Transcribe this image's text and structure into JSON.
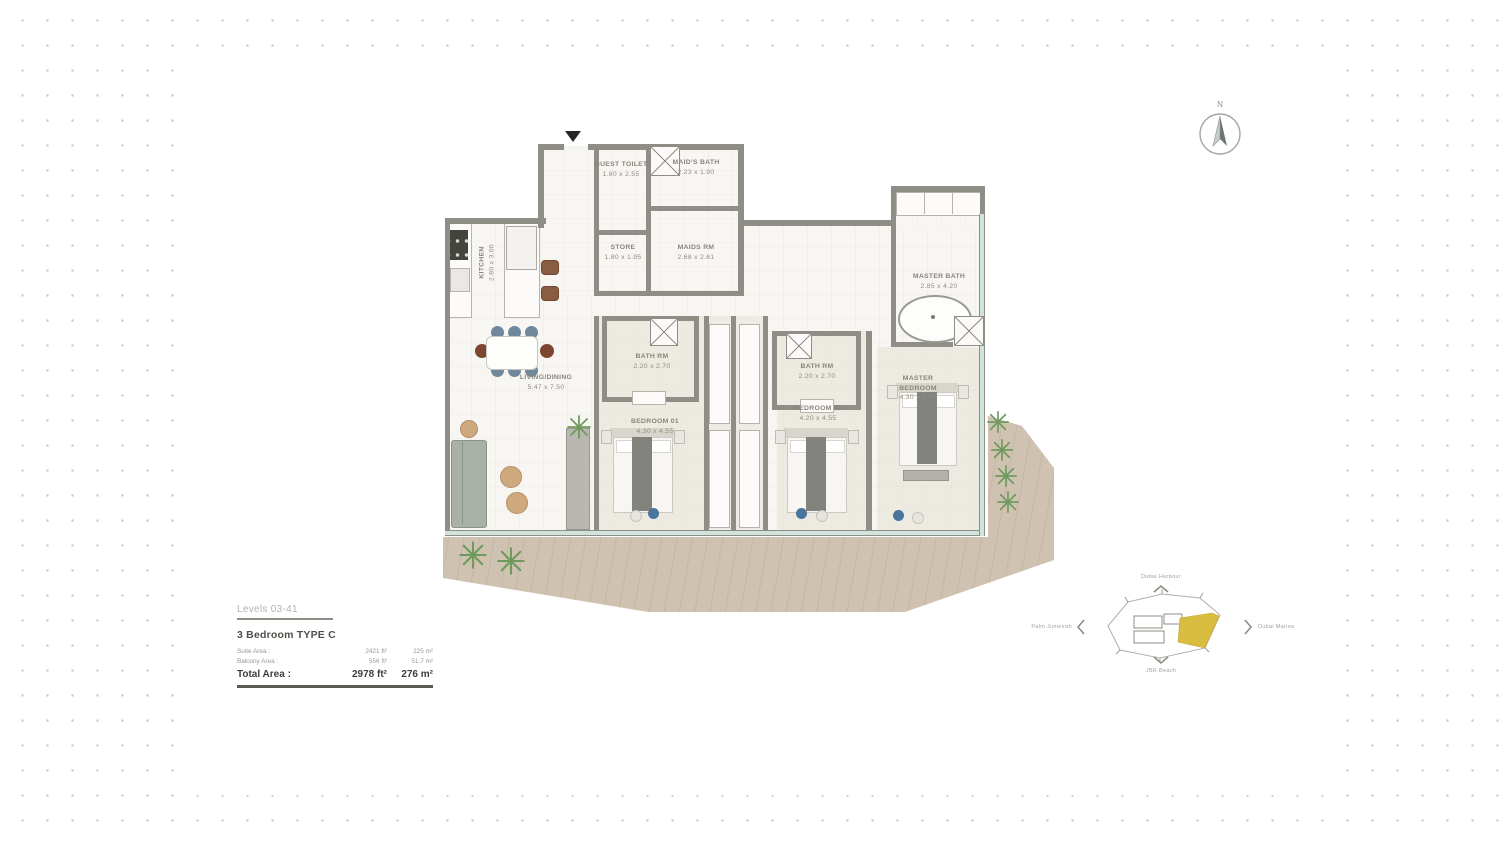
{
  "legend": {
    "levels": "Levels 03-41",
    "unit_type": "3 Bedroom  TYPE C",
    "rows": [
      {
        "label": "Suite Area :",
        "ft": "2421 ft²",
        "m": "225 m²"
      },
      {
        "label": "Balcony Area :",
        "ft": "556 ft²",
        "m": "51.7 m²"
      }
    ],
    "total": {
      "label": "Total Area :",
      "ft": "2978 ft²",
      "m": "276 m²"
    }
  },
  "compass": {
    "north_label": "N"
  },
  "plan": {
    "rooms": [
      {
        "name": "KITCHEN",
        "dims": "2.80 x 3.00"
      },
      {
        "name": "GUEST TOILET",
        "dims": "1.80 x 2.55"
      },
      {
        "name": "MAID'S BATH",
        "dims": "2.23 x 1.90"
      },
      {
        "name": "STORE",
        "dims": "1.80 x 1.95"
      },
      {
        "name": "MAIDS RM",
        "dims": "2.68 x 2.61"
      },
      {
        "name": "LIVING/DINING",
        "dims": "5.47 x 7.50"
      },
      {
        "name": "BATH RM",
        "dims": "2.20 x 2.70"
      },
      {
        "name": "BEDROOM 01",
        "dims": "4.30 x 4.55"
      },
      {
        "name": "BATH RM",
        "dims": "2.20 x 2.70"
      },
      {
        "name": "BEDROOM 02",
        "dims": "4.20 x 4.55"
      },
      {
        "name": "MASTER BATH",
        "dims": "2.85 x 4.20"
      },
      {
        "name": "MASTER BEDROOM",
        "dims": "4.30 x 4.70"
      }
    ]
  },
  "locator": {
    "labels": {
      "top": "Dubai Harbour",
      "left": "Palm Jumeirah",
      "right": "Dubai Marina",
      "bottom": "JBR Beach"
    },
    "highlight_color": "#d9bd40"
  },
  "colors": {
    "wall": "#8e8d86",
    "glass": "#cfe4dc",
    "deck": "#cfc2b1",
    "plant": "#6f9a5e",
    "label_text": "#8f8d84",
    "dot_grid": "#c6c6c6"
  }
}
